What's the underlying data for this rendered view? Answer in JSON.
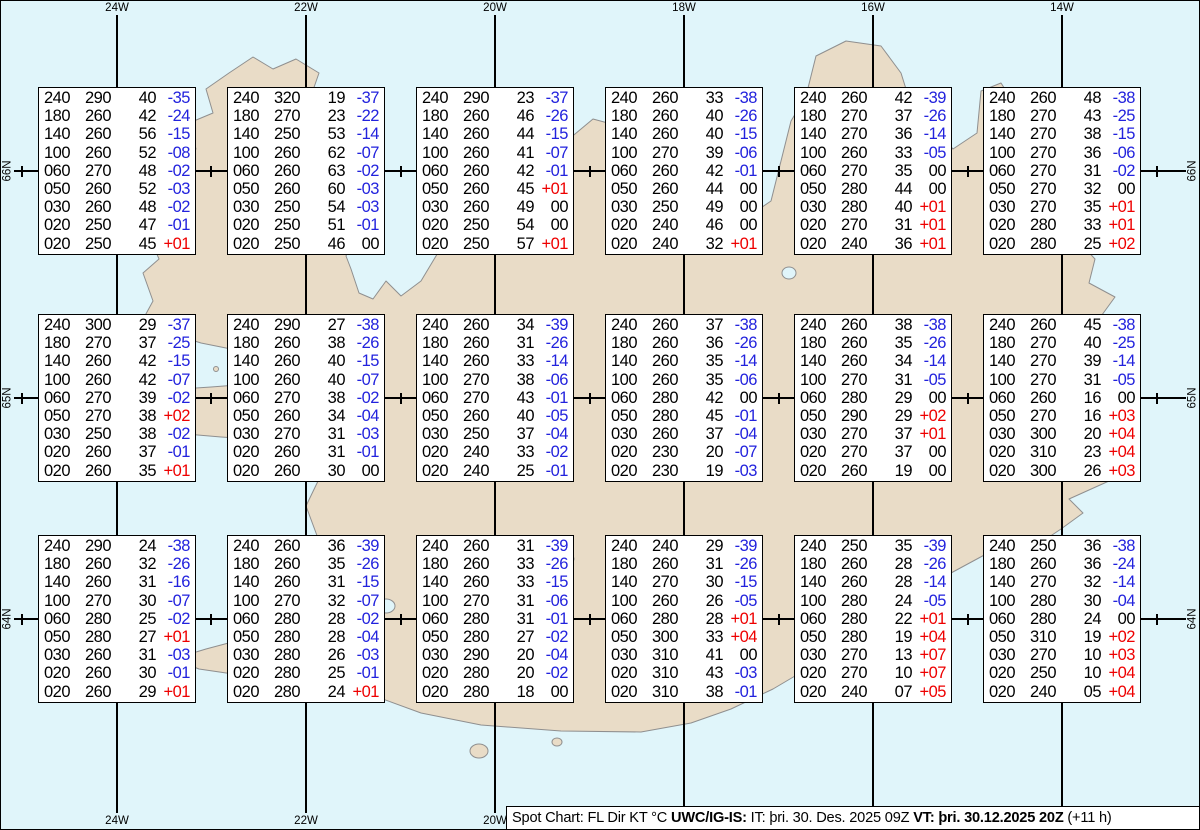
{
  "colors": {
    "ocean": "#e0f5fa",
    "land": "#e9dcc7",
    "temp_negative": "#2222dd",
    "temp_positive": "#ee0000"
  },
  "info_bar": {
    "title": "Spot Chart: FL Dir KT °C ",
    "source": "UWC/IG-IS:",
    "issue": " IT: þri. 30. Des. 2025 09Z ",
    "valid": "VT: þri. 30.12.2025 20Z",
    "offset": " (+11 h)"
  },
  "axes": {
    "meridians": [
      {
        "label": "24W",
        "x": 116
      },
      {
        "label": "22W",
        "x": 305
      },
      {
        "label": "20W",
        "x": 494
      },
      {
        "label": "18W",
        "x": 683
      },
      {
        "label": "16W",
        "x": 872
      },
      {
        "label": "14W",
        "x": 1061
      }
    ],
    "parallels": [
      {
        "label": "66N",
        "y": 170
      },
      {
        "label": "65N",
        "y": 397
      },
      {
        "label": "64N",
        "y": 618
      }
    ],
    "half_degree_tick_xs": [
      21,
      210,
      400,
      589,
      778,
      967,
      1156
    ]
  },
  "chart_data": {
    "type": "table",
    "title": "Spot Chart: FL Dir KT °C",
    "columns": [
      "FL",
      "Dir",
      "KT",
      "°C"
    ],
    "spots": [
      {
        "lat": "66N",
        "lon": "24W",
        "rows": [
          [
            "240",
            "290",
            "40",
            "-35"
          ],
          [
            "180",
            "260",
            "42",
            "-24"
          ],
          [
            "140",
            "260",
            "56",
            "-15"
          ],
          [
            "100",
            "260",
            "52",
            "-08"
          ],
          [
            "060",
            "270",
            "48",
            "-02"
          ],
          [
            "050",
            "260",
            "52",
            "-03"
          ],
          [
            "030",
            "260",
            "48",
            "-02"
          ],
          [
            "020",
            "250",
            "47",
            "-01"
          ],
          [
            "020",
            "250",
            "45",
            "+01"
          ]
        ]
      },
      {
        "lat": "66N",
        "lon": "22W",
        "rows": [
          [
            "240",
            "320",
            "19",
            "-37"
          ],
          [
            "180",
            "270",
            "23",
            "-22"
          ],
          [
            "140",
            "250",
            "53",
            "-14"
          ],
          [
            "100",
            "260",
            "62",
            "-07"
          ],
          [
            "060",
            "260",
            "63",
            "-02"
          ],
          [
            "050",
            "260",
            "60",
            "-03"
          ],
          [
            "030",
            "250",
            "54",
            "-03"
          ],
          [
            "020",
            "250",
            "51",
            "-01"
          ],
          [
            "020",
            "250",
            "46",
            "00"
          ]
        ]
      },
      {
        "lat": "66N",
        "lon": "20W",
        "rows": [
          [
            "240",
            "290",
            "23",
            "-37"
          ],
          [
            "180",
            "260",
            "46",
            "-26"
          ],
          [
            "140",
            "260",
            "44",
            "-15"
          ],
          [
            "100",
            "260",
            "41",
            "-07"
          ],
          [
            "060",
            "260",
            "42",
            "-01"
          ],
          [
            "050",
            "260",
            "45",
            "+01"
          ],
          [
            "030",
            "260",
            "49",
            "00"
          ],
          [
            "020",
            "250",
            "54",
            "00"
          ],
          [
            "020",
            "250",
            "57",
            "+01"
          ]
        ]
      },
      {
        "lat": "66N",
        "lon": "18W",
        "rows": [
          [
            "240",
            "260",
            "33",
            "-38"
          ],
          [
            "180",
            "260",
            "40",
            "-26"
          ],
          [
            "140",
            "260",
            "40",
            "-15"
          ],
          [
            "100",
            "270",
            "39",
            "-06"
          ],
          [
            "060",
            "260",
            "42",
            "-01"
          ],
          [
            "050",
            "260",
            "44",
            "00"
          ],
          [
            "030",
            "250",
            "49",
            "00"
          ],
          [
            "020",
            "240",
            "46",
            "00"
          ],
          [
            "020",
            "240",
            "32",
            "+01"
          ]
        ]
      },
      {
        "lat": "66N",
        "lon": "16W",
        "rows": [
          [
            "240",
            "260",
            "42",
            "-39"
          ],
          [
            "180",
            "270",
            "37",
            "-26"
          ],
          [
            "140",
            "270",
            "36",
            "-14"
          ],
          [
            "100",
            "260",
            "33",
            "-05"
          ],
          [
            "060",
            "270",
            "35",
            "00"
          ],
          [
            "050",
            "280",
            "44",
            "00"
          ],
          [
            "030",
            "280",
            "40",
            "+01"
          ],
          [
            "020",
            "270",
            "31",
            "+01"
          ],
          [
            "020",
            "240",
            "36",
            "+01"
          ]
        ]
      },
      {
        "lat": "66N",
        "lon": "14W",
        "rows": [
          [
            "240",
            "260",
            "48",
            "-38"
          ],
          [
            "180",
            "270",
            "43",
            "-25"
          ],
          [
            "140",
            "270",
            "38",
            "-15"
          ],
          [
            "100",
            "270",
            "36",
            "-06"
          ],
          [
            "060",
            "270",
            "31",
            "-02"
          ],
          [
            "050",
            "270",
            "32",
            "00"
          ],
          [
            "030",
            "270",
            "35",
            "+01"
          ],
          [
            "020",
            "280",
            "33",
            "+01"
          ],
          [
            "020",
            "280",
            "25",
            "+02"
          ]
        ]
      },
      {
        "lat": "65N",
        "lon": "24W",
        "rows": [
          [
            "240",
            "300",
            "29",
            "-37"
          ],
          [
            "180",
            "270",
            "37",
            "-25"
          ],
          [
            "140",
            "260",
            "42",
            "-15"
          ],
          [
            "100",
            "260",
            "42",
            "-07"
          ],
          [
            "060",
            "270",
            "39",
            "-02"
          ],
          [
            "050",
            "270",
            "38",
            "+02"
          ],
          [
            "030",
            "250",
            "38",
            "-02"
          ],
          [
            "020",
            "260",
            "37",
            "-01"
          ],
          [
            "020",
            "260",
            "35",
            "+01"
          ]
        ]
      },
      {
        "lat": "65N",
        "lon": "22W",
        "rows": [
          [
            "240",
            "290",
            "27",
            "-38"
          ],
          [
            "180",
            "260",
            "38",
            "-26"
          ],
          [
            "140",
            "260",
            "40",
            "-15"
          ],
          [
            "100",
            "260",
            "40",
            "-07"
          ],
          [
            "060",
            "270",
            "38",
            "-02"
          ],
          [
            "050",
            "260",
            "34",
            "-04"
          ],
          [
            "030",
            "270",
            "31",
            "-03"
          ],
          [
            "020",
            "260",
            "31",
            "-01"
          ],
          [
            "020",
            "260",
            "30",
            "00"
          ]
        ]
      },
      {
        "lat": "65N",
        "lon": "20W",
        "rows": [
          [
            "240",
            "260",
            "34",
            "-39"
          ],
          [
            "180",
            "260",
            "31",
            "-26"
          ],
          [
            "140",
            "260",
            "33",
            "-14"
          ],
          [
            "100",
            "270",
            "38",
            "-06"
          ],
          [
            "060",
            "270",
            "43",
            "-01"
          ],
          [
            "050",
            "260",
            "40",
            "-05"
          ],
          [
            "030",
            "250",
            "37",
            "-04"
          ],
          [
            "020",
            "240",
            "33",
            "-02"
          ],
          [
            "020",
            "240",
            "25",
            "-01"
          ]
        ]
      },
      {
        "lat": "65N",
        "lon": "18W",
        "rows": [
          [
            "240",
            "260",
            "37",
            "-38"
          ],
          [
            "180",
            "260",
            "36",
            "-26"
          ],
          [
            "140",
            "260",
            "35",
            "-14"
          ],
          [
            "100",
            "260",
            "35",
            "-06"
          ],
          [
            "060",
            "280",
            "42",
            "00"
          ],
          [
            "050",
            "280",
            "45",
            "-01"
          ],
          [
            "030",
            "260",
            "37",
            "-04"
          ],
          [
            "020",
            "230",
            "20",
            "-07"
          ],
          [
            "020",
            "230",
            "19",
            "-03"
          ]
        ]
      },
      {
        "lat": "65N",
        "lon": "16W",
        "rows": [
          [
            "240",
            "260",
            "38",
            "-38"
          ],
          [
            "180",
            "260",
            "35",
            "-26"
          ],
          [
            "140",
            "260",
            "34",
            "-14"
          ],
          [
            "100",
            "270",
            "31",
            "-05"
          ],
          [
            "060",
            "280",
            "29",
            "00"
          ],
          [
            "050",
            "290",
            "29",
            "+02"
          ],
          [
            "030",
            "270",
            "37",
            "+01"
          ],
          [
            "020",
            "270",
            "37",
            "00"
          ],
          [
            "020",
            "260",
            "19",
            "00"
          ]
        ]
      },
      {
        "lat": "65N",
        "lon": "14W",
        "rows": [
          [
            "240",
            "260",
            "45",
            "-38"
          ],
          [
            "180",
            "270",
            "40",
            "-25"
          ],
          [
            "140",
            "270",
            "39",
            "-14"
          ],
          [
            "100",
            "270",
            "31",
            "-05"
          ],
          [
            "060",
            "260",
            "16",
            "00"
          ],
          [
            "050",
            "270",
            "16",
            "+03"
          ],
          [
            "030",
            "300",
            "20",
            "+04"
          ],
          [
            "020",
            "310",
            "23",
            "+04"
          ],
          [
            "020",
            "300",
            "26",
            "+03"
          ]
        ]
      },
      {
        "lat": "64N",
        "lon": "24W",
        "rows": [
          [
            "240",
            "290",
            "24",
            "-38"
          ],
          [
            "180",
            "260",
            "32",
            "-26"
          ],
          [
            "140",
            "260",
            "31",
            "-16"
          ],
          [
            "100",
            "270",
            "30",
            "-07"
          ],
          [
            "060",
            "280",
            "25",
            "-02"
          ],
          [
            "050",
            "280",
            "27",
            "+01"
          ],
          [
            "030",
            "260",
            "31",
            "-03"
          ],
          [
            "020",
            "260",
            "30",
            "-01"
          ],
          [
            "020",
            "260",
            "29",
            "+01"
          ]
        ]
      },
      {
        "lat": "64N",
        "lon": "22W",
        "rows": [
          [
            "240",
            "260",
            "36",
            "-39"
          ],
          [
            "180",
            "260",
            "35",
            "-26"
          ],
          [
            "140",
            "260",
            "31",
            "-15"
          ],
          [
            "100",
            "270",
            "32",
            "-07"
          ],
          [
            "060",
            "280",
            "28",
            "-02"
          ],
          [
            "050",
            "280",
            "28",
            "-04"
          ],
          [
            "030",
            "280",
            "26",
            "-03"
          ],
          [
            "020",
            "280",
            "25",
            "-01"
          ],
          [
            "020",
            "280",
            "24",
            "+01"
          ]
        ]
      },
      {
        "lat": "64N",
        "lon": "20W",
        "rows": [
          [
            "240",
            "260",
            "31",
            "-39"
          ],
          [
            "180",
            "260",
            "33",
            "-26"
          ],
          [
            "140",
            "260",
            "33",
            "-15"
          ],
          [
            "100",
            "270",
            "31",
            "-06"
          ],
          [
            "060",
            "280",
            "31",
            "-01"
          ],
          [
            "050",
            "280",
            "27",
            "-02"
          ],
          [
            "030",
            "290",
            "20",
            "-04"
          ],
          [
            "020",
            "280",
            "20",
            "-02"
          ],
          [
            "020",
            "280",
            "18",
            "00"
          ]
        ]
      },
      {
        "lat": "64N",
        "lon": "18W",
        "rows": [
          [
            "240",
            "240",
            "29",
            "-39"
          ],
          [
            "180",
            "260",
            "31",
            "-26"
          ],
          [
            "140",
            "270",
            "30",
            "-15"
          ],
          [
            "100",
            "260",
            "26",
            "-05"
          ],
          [
            "060",
            "280",
            "28",
            "+01"
          ],
          [
            "050",
            "300",
            "33",
            "+04"
          ],
          [
            "030",
            "310",
            "41",
            "00"
          ],
          [
            "020",
            "310",
            "43",
            "-03"
          ],
          [
            "020",
            "310",
            "38",
            "-01"
          ]
        ]
      },
      {
        "lat": "64N",
        "lon": "16W",
        "rows": [
          [
            "240",
            "250",
            "35",
            "-39"
          ],
          [
            "180",
            "260",
            "28",
            "-26"
          ],
          [
            "140",
            "260",
            "28",
            "-14"
          ],
          [
            "100",
            "280",
            "24",
            "-05"
          ],
          [
            "060",
            "280",
            "22",
            "+01"
          ],
          [
            "050",
            "280",
            "19",
            "+04"
          ],
          [
            "030",
            "270",
            "13",
            "+07"
          ],
          [
            "020",
            "270",
            "10",
            "+07"
          ],
          [
            "020",
            "240",
            "07",
            "+05"
          ]
        ]
      },
      {
        "lat": "64N",
        "lon": "14W",
        "rows": [
          [
            "240",
            "250",
            "36",
            "-38"
          ],
          [
            "180",
            "260",
            "36",
            "-24"
          ],
          [
            "140",
            "270",
            "32",
            "-14"
          ],
          [
            "100",
            "280",
            "30",
            "-04"
          ],
          [
            "060",
            "280",
            "24",
            "00"
          ],
          [
            "050",
            "310",
            "19",
            "+02"
          ],
          [
            "030",
            "270",
            "10",
            "+03"
          ],
          [
            "020",
            "250",
            "10",
            "+04"
          ],
          [
            "020",
            "240",
            "05",
            "+04"
          ]
        ]
      }
    ]
  }
}
